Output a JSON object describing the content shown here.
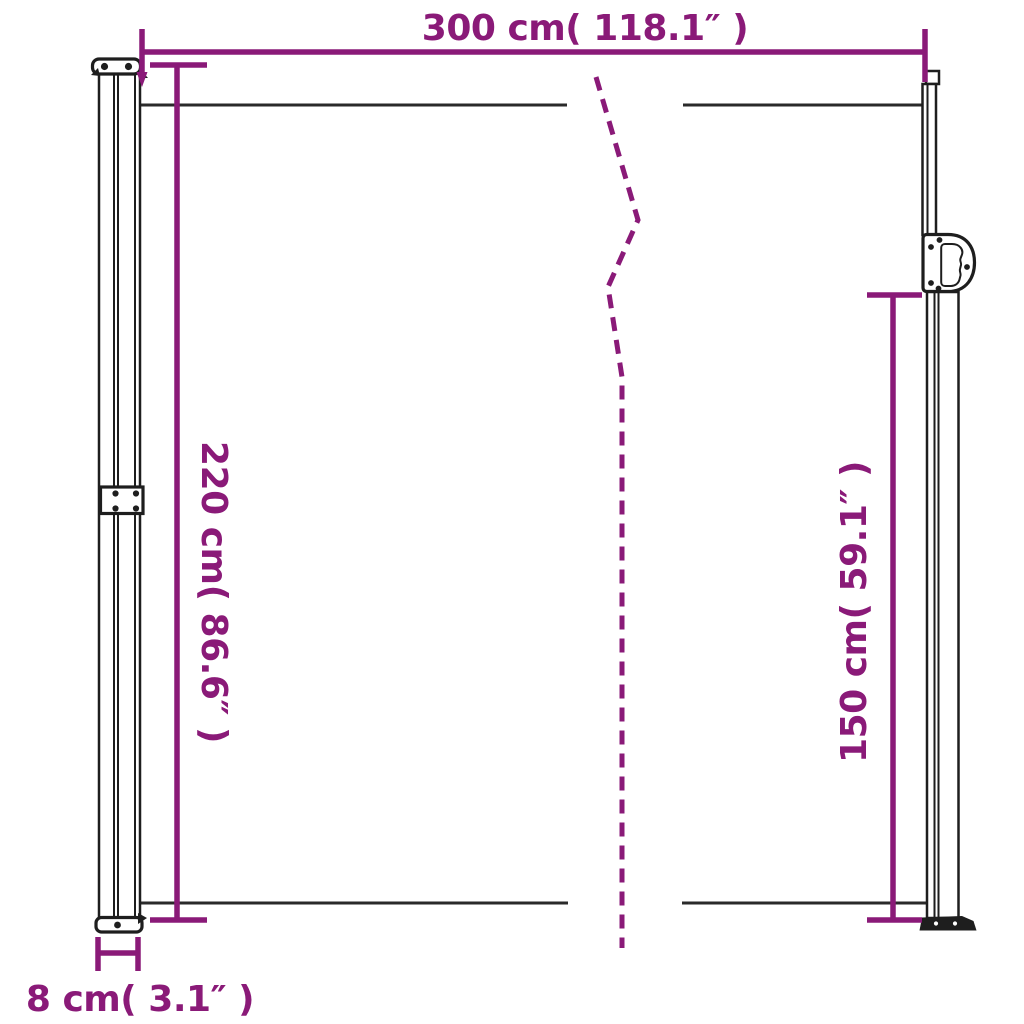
{
  "colors": {
    "accent": "#8a1a78",
    "line": "#2a2a2a",
    "structure": "#1e1e1e",
    "bg": "#ffffff"
  },
  "dimensions": {
    "width_top": {
      "label": "300 cm( 118.1″ )",
      "cm": 300,
      "inches": 118.1
    },
    "height_left": {
      "label": "220 cm( 86.6″ )",
      "cm": 220,
      "inches": 86.6
    },
    "height_right": {
      "label": "150 cm( 59.1″ )",
      "cm": 150,
      "inches": 59.1
    },
    "depth_bottom": {
      "label": "8 cm( 3.1″ )",
      "cm": 8,
      "inches": 3.1
    }
  }
}
